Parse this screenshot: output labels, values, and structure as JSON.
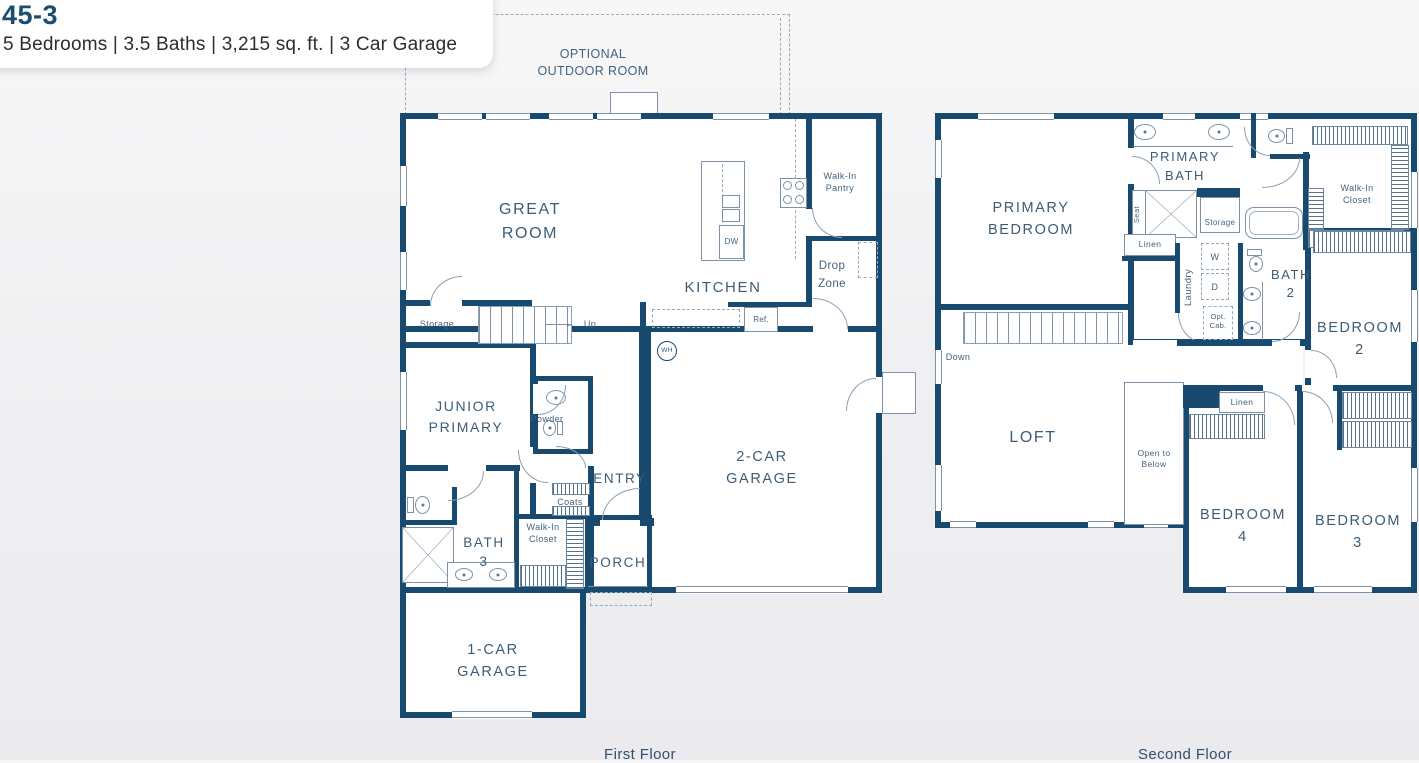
{
  "header": {
    "plan_number": "45-3",
    "specs": "5 Bedrooms | 3.5 Baths | 3,215 sq. ft. | 3 Car Garage"
  },
  "colors": {
    "wall": "#174a6e",
    "detail_line": "#7d92a8",
    "room_label": "#3d5c76",
    "plan_number": "#1b4d72",
    "background": "#f1f1f3"
  },
  "floor1": {
    "caption": "First Floor",
    "labels": {
      "optional_outdoor_room": "OPTIONAL OUTDOOR ROOM",
      "great_room": "GREAT ROOM",
      "kitchen": "KITCHEN",
      "walk_in_pantry": "Walk-In Pantry",
      "drop_zone": "Drop Zone",
      "storage": "Storage",
      "up": "Up",
      "up_arrow": "←",
      "ref": "Ref.",
      "dw": "DW",
      "wh": "WH",
      "junior_primary": "JUNIOR PRIMARY",
      "powder": "Powder",
      "entry": "ENTRY",
      "coats": "Coats",
      "walk_in_closet": "Walk-In Closet",
      "bath_3": "BATH 3",
      "porch": "PORCH",
      "two_car_garage": "2-CAR GARAGE",
      "one_car_garage": "1-CAR GARAGE"
    }
  },
  "floor2": {
    "caption": "Second Floor",
    "labels": {
      "primary_bedroom": "PRIMARY BEDROOM",
      "primary_bath": "PRIMARY BATH",
      "seat": "Seat",
      "storage": "Storage",
      "linen_hall": "Linen",
      "walk_in_closet": "Walk-In Closet",
      "laundry": "Laundry",
      "washer": "W",
      "dryer": "D",
      "opt_cab": "Opt. Cab.",
      "bath_2": "BATH 2",
      "bedroom_2": "BEDROOM 2",
      "down": "Down",
      "loft": "LOFT",
      "open_to_below": "Open to Below",
      "linen_bed4": "Linen",
      "bedroom_4": "BEDROOM 4",
      "bedroom_3": "BEDROOM 3"
    }
  }
}
